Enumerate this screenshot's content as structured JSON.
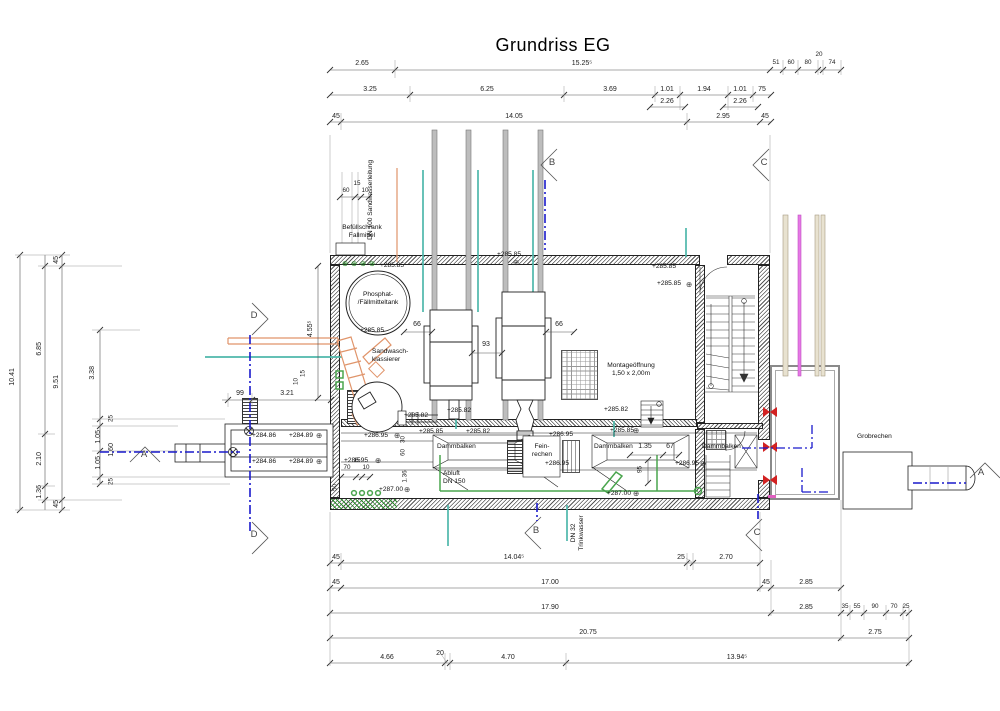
{
  "labels": {
    "title": "Grundriss EG",
    "befuellschrank": "Befüllschrank\nFallmittel",
    "sandwasserleitung": "DN 100 Sandwasserleitung",
    "phosphattank": "Phosphat-\n/Fällmitteltank",
    "sandwaschklassierer": "Sandwasch-\nklassierer",
    "montageoeffnung": "Montageöffnung\n1,50 x 2,00m",
    "dammbalken": "Dammbalken",
    "feinrechen": "Fein-\nrechen",
    "abluft": "Abluft\nDN 150",
    "grobrechen": "Grobrechen",
    "trinkwasser": "DN 32\nTrinkwasser"
  },
  "sections": {
    "a": "A",
    "b": "B",
    "c": "C",
    "d": "D"
  },
  "dims": {
    "top1": [
      "2.65",
      "15.25⁵",
      "51",
      "60",
      "80",
      "20",
      "74"
    ],
    "top2": [
      "3.25",
      "6.25",
      "3.69",
      "1.01",
      "2.26",
      "1.94",
      "1.01",
      "2.26",
      "75"
    ],
    "top3": [
      "45",
      "14.05",
      "2.95",
      "45"
    ],
    "bottom1": [
      "45",
      "14.04⁵",
      "25",
      "2.70"
    ],
    "bottom2": [
      "45",
      "17.00",
      "45",
      "2.85"
    ],
    "bottom3": [
      "17.90",
      "2.85",
      "35",
      "55",
      "90",
      "70",
      "25"
    ],
    "bottom4": [
      "20.75",
      "2.75"
    ],
    "bottom5": [
      "4.66",
      "20",
      "4.70",
      "13.94⁵"
    ],
    "left": [
      "10.41",
      "6.85",
      "2.10",
      "1.36",
      "45",
      "9.51",
      "45",
      "3.38",
      "25",
      "1.05",
      "1.60",
      "1.05",
      "25"
    ],
    "small_top": [
      "60",
      "15",
      "10"
    ],
    "small_bottom": [
      "70",
      "15",
      "10"
    ],
    "entry": [
      "99",
      "3.21",
      "10",
      "15",
      "4.55⁵"
    ],
    "plan": [
      "66",
      "93",
      "66",
      "1.35",
      "67",
      "95",
      "1.36",
      "30",
      "60",
      "50"
    ]
  },
  "elevations": [
    "+285.85",
    "+285.85",
    "+285.85",
    "+285.85",
    "+285.85",
    "+285.82",
    "+285.85",
    "+285.82",
    "+285.82",
    "+286.95",
    "+286.95",
    "+285.82",
    "+285.85",
    "+286.95",
    "+286.95",
    "+286.95",
    "+287.00",
    "+287.00",
    "+284.86",
    "+284.89",
    "+284.86",
    "+284.89"
  ],
  "icons": {
    "survey_marker": "⊕",
    "valve": "⊗"
  },
  "colors": {
    "section_line": "#1a1acc",
    "pipe_teal": "#4fb8ab",
    "pipe_green": "#4aa54e",
    "pipe_orange": "#e0946a",
    "pipe_magenta": "#e678e6",
    "pipe_beige": "#e8e2d0",
    "pipe_gray": "#bdbdbd",
    "valve_red": "#d22222"
  }
}
